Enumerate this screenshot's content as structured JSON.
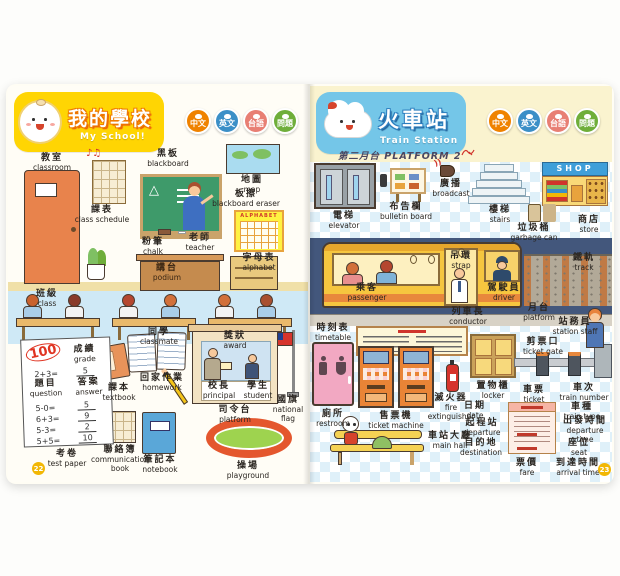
{
  "book": {
    "language_buttons": [
      {
        "label": "中文",
        "color": "#ef8200"
      },
      {
        "label": "英文",
        "color": "#3b8fc7"
      },
      {
        "label": "台語",
        "color": "#e87f74"
      },
      {
        "label": "問題",
        "color": "#6fae3a"
      }
    ]
  },
  "school": {
    "page_number": "22",
    "banner": {
      "title": "我的學校",
      "subtitle": "My School!",
      "color": "#ffd503"
    },
    "music_notes": "♪♫",
    "alphabet_title": "ALPHABET",
    "test_paper": {
      "score": "100",
      "problems": [
        {
          "q": "2+3=",
          "a": "5"
        },
        {
          "q": "5-0=",
          "a": "5"
        },
        {
          "q": "6+3=",
          "a": "9"
        },
        {
          "q": "5-3=",
          "a": "2"
        },
        {
          "q": "5+5=",
          "a": "10"
        }
      ]
    },
    "labels": {
      "classroom": {
        "zh": "教室",
        "en": "classroom"
      },
      "class_schedule": {
        "zh": "課表",
        "en": "class schedule"
      },
      "blackboard": {
        "zh": "黑板",
        "en": "blackboard"
      },
      "blackboard_eraser": {
        "zh": "板擦",
        "en": "blackboard eraser"
      },
      "chalk": {
        "zh": "粉筆",
        "en": "chalk"
      },
      "map": {
        "zh": "地圖",
        "en": "map"
      },
      "alphabet": {
        "zh": "字母表",
        "en": "alphabet"
      },
      "teacher": {
        "zh": "老師",
        "en": "teacher"
      },
      "podium": {
        "zh": "講台",
        "en": "podium"
      },
      "class": {
        "zh": "班級",
        "en": "class"
      },
      "classmate": {
        "zh": "同學",
        "en": "classmate"
      },
      "grade": {
        "zh": "成績",
        "en": "grade"
      },
      "question": {
        "zh": "題目",
        "en": "question"
      },
      "answer": {
        "zh": "答案",
        "en": "answer"
      },
      "test_paper": {
        "zh": "考卷",
        "en": "test paper"
      },
      "textbook": {
        "zh": "課本",
        "en": "textbook"
      },
      "homework": {
        "zh": "回家作業",
        "en": "homework"
      },
      "communication_book": {
        "zh": "聯絡簿",
        "en": "communication book"
      },
      "notebook": {
        "zh": "筆記本",
        "en": "notebook"
      },
      "award": {
        "zh": "獎狀",
        "en": "award"
      },
      "principal": {
        "zh": "校長",
        "en": "principal"
      },
      "student": {
        "zh": "學生",
        "en": "student"
      },
      "national_flag": {
        "zh": "國旗",
        "en": "national flag"
      },
      "platform": {
        "zh": "司令台",
        "en": "platform"
      },
      "playground": {
        "zh": "操場",
        "en": "playground"
      }
    }
  },
  "station": {
    "page_number": "23",
    "banner": {
      "title": "火車站",
      "subtitle": "Train Station",
      "color": "#74c6e8"
    },
    "platform_sign": "第二月台 PLATFORM 2",
    "shop_sign": "SHOP",
    "labels": {
      "elevator": {
        "zh": "電梯",
        "en": "elevator"
      },
      "bulletin_board": {
        "zh": "布告欄",
        "en": "bulletin board"
      },
      "broadcast": {
        "zh": "廣播",
        "en": "broadcast"
      },
      "stairs": {
        "zh": "樓梯",
        "en": "stairs"
      },
      "store": {
        "zh": "商店",
        "en": "store"
      },
      "garbage_can": {
        "zh": "垃圾桶",
        "en": "garbage can"
      },
      "track": {
        "zh": "鐵軌",
        "en": "track"
      },
      "strap": {
        "zh": "吊環",
        "en": "strap"
      },
      "passenger": {
        "zh": "乘客",
        "en": "passenger"
      },
      "conductor": {
        "zh": "列車長",
        "en": "conductor"
      },
      "driver": {
        "zh": "駕駛員",
        "en": "driver"
      },
      "platform": {
        "zh": "月台",
        "en": "platform"
      },
      "timetable": {
        "zh": "時刻表",
        "en": "timetable"
      },
      "station_staff": {
        "zh": "站務員",
        "en": "station staff"
      },
      "ticket_gate": {
        "zh": "剪票口",
        "en": "ticket gate"
      },
      "restroom": {
        "zh": "廁所",
        "en": "restroom"
      },
      "ticket_machine": {
        "zh": "售票機",
        "en": "ticket machine"
      },
      "fire_extinguisher": {
        "zh": "滅火器",
        "en": "fire extinguisher"
      },
      "locker": {
        "zh": "置物櫃",
        "en": "locker"
      },
      "main_hall": {
        "zh": "車站大廳",
        "en": "main hall"
      },
      "ticket": {
        "zh": "車票",
        "en": "ticket"
      },
      "train_number": {
        "zh": "車次",
        "en": "train number"
      },
      "train_type": {
        "zh": "車種",
        "en": "train type"
      },
      "date": {
        "zh": "日期",
        "en": "date"
      },
      "departure": {
        "zh": "起程站",
        "en": "departure"
      },
      "departure_time": {
        "zh": "出發時間",
        "en": "departure time"
      },
      "destination": {
        "zh": "目的地",
        "en": "destination"
      },
      "seat": {
        "zh": "座位",
        "en": "seat"
      },
      "fare": {
        "zh": "票價",
        "en": "fare"
      },
      "arrival_time": {
        "zh": "到達時間",
        "en": "arrival time"
      }
    }
  }
}
